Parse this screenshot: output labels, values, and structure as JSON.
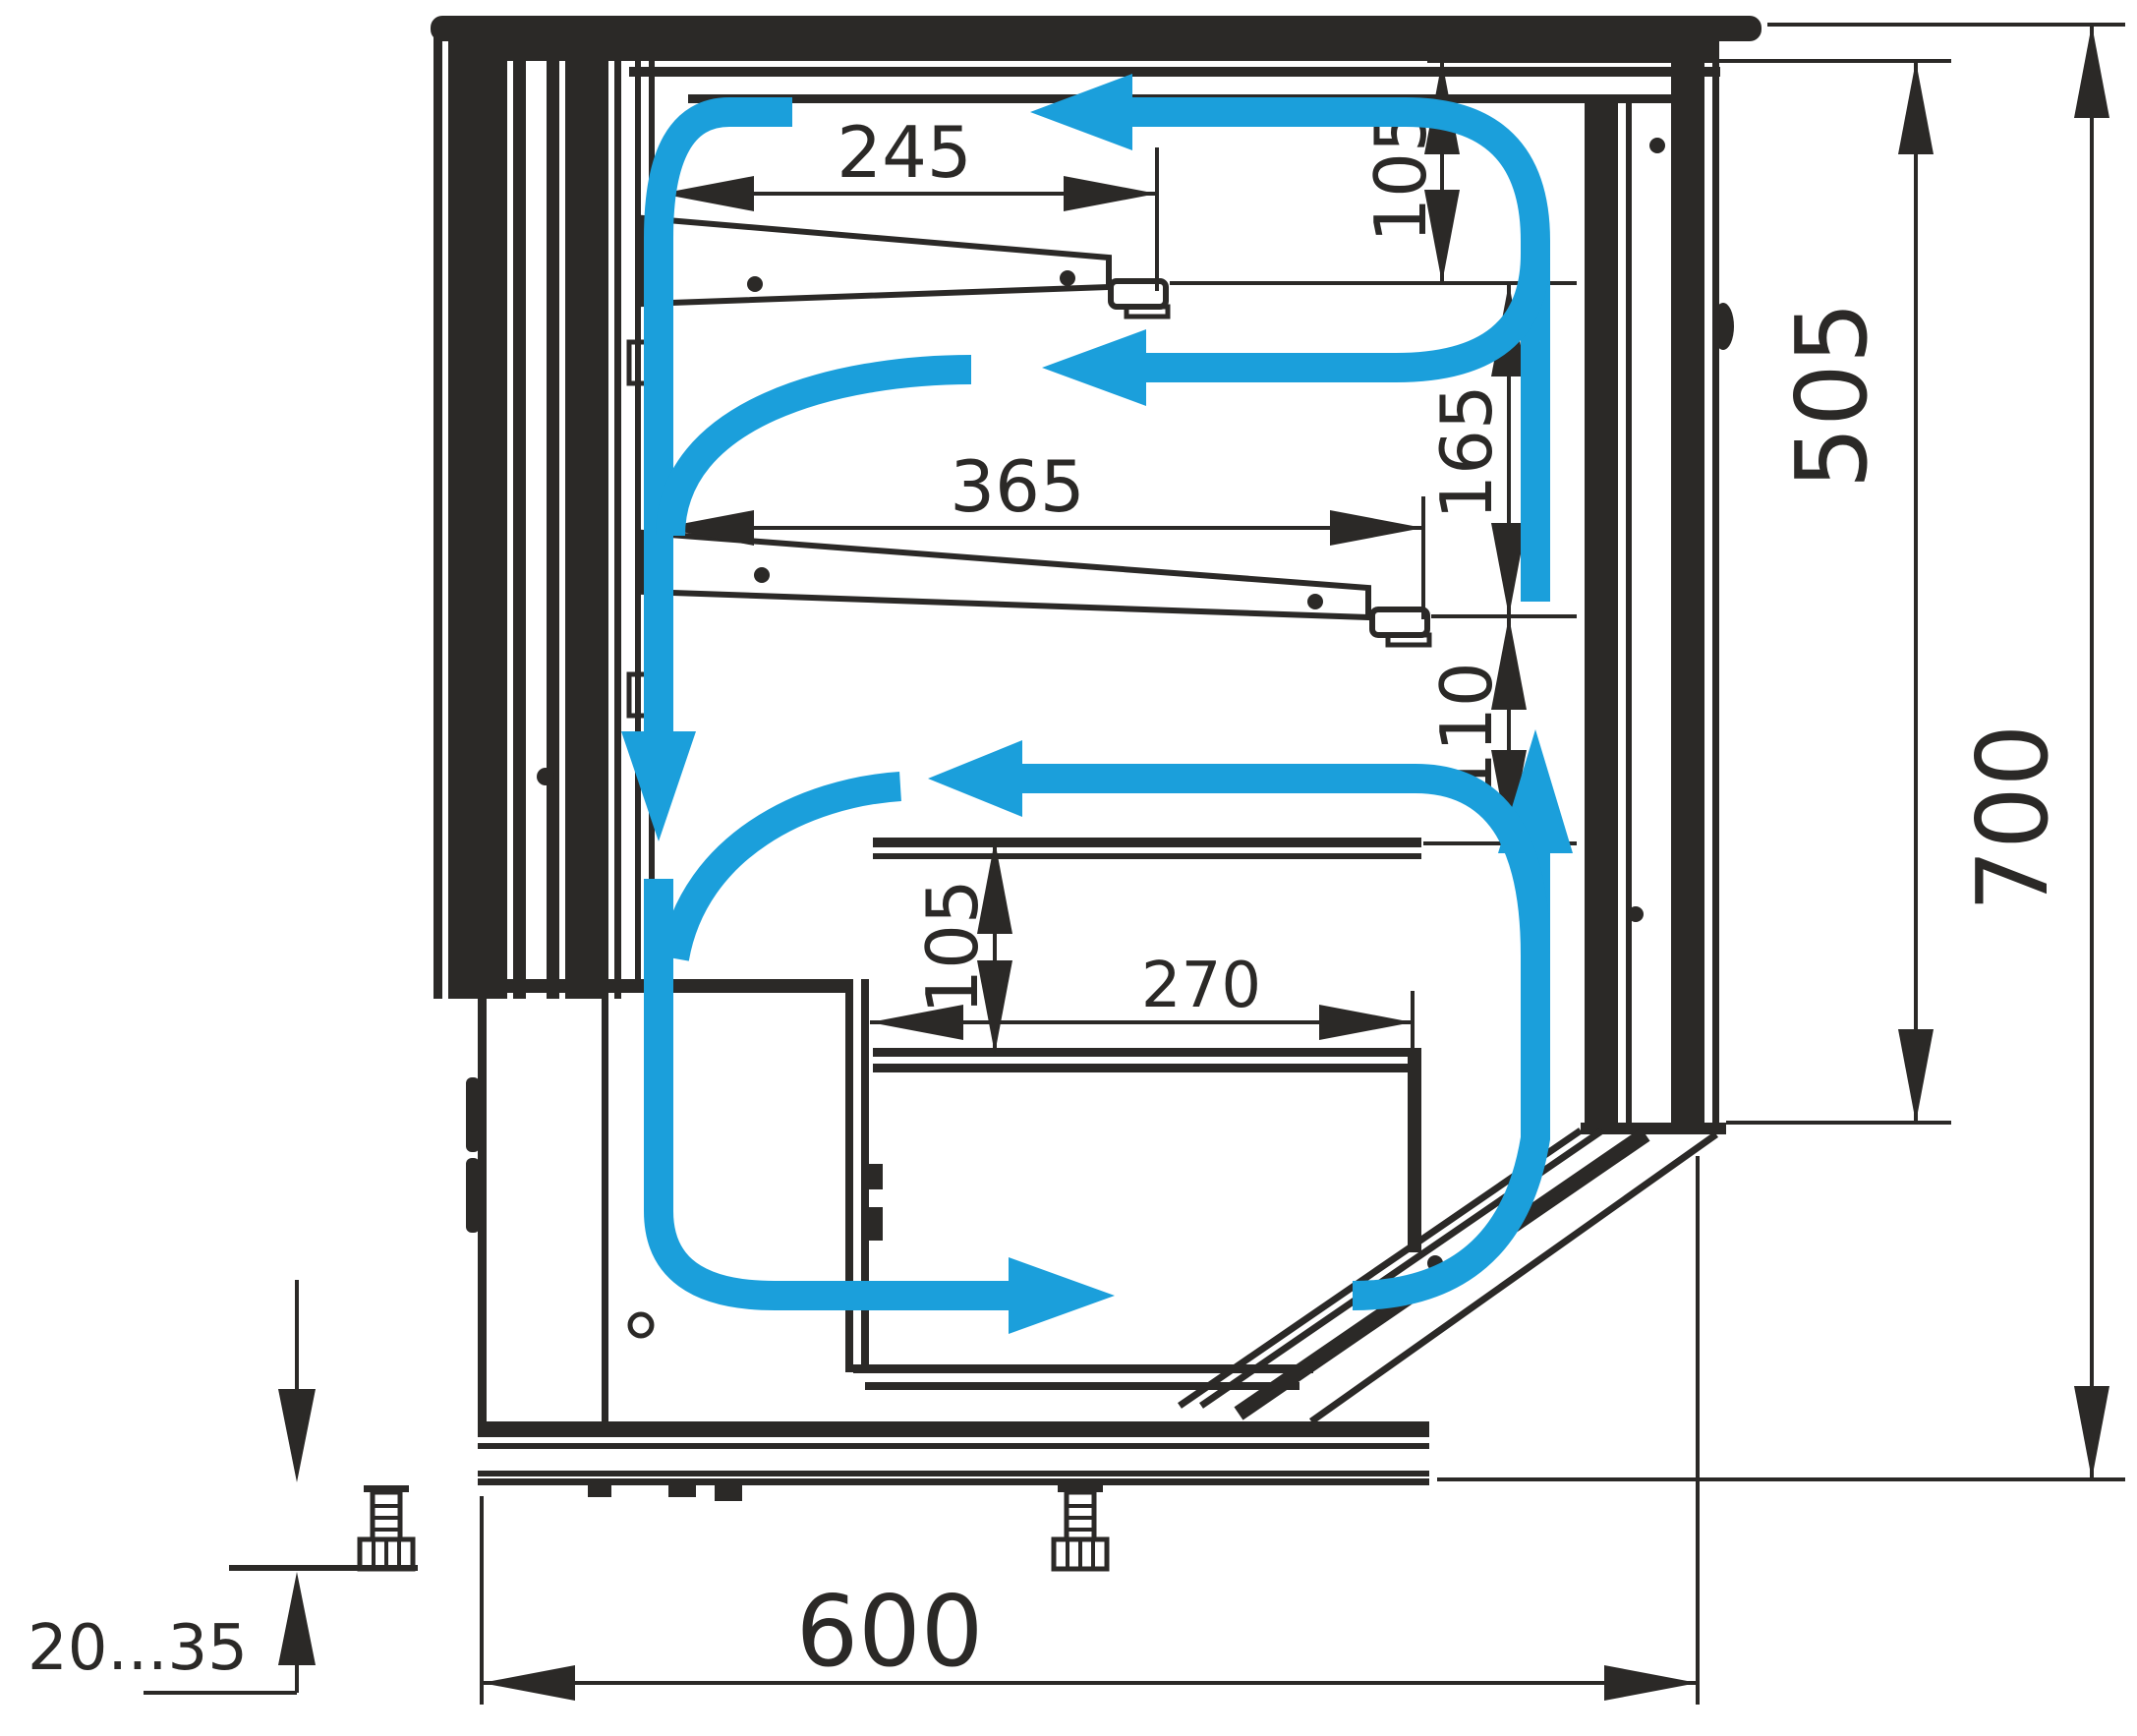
{
  "drawing": {
    "kind": "refrigerated-display-case-side-section-with-airflow",
    "dimensions": {
      "shelf_top_depth": {
        "label": "245"
      },
      "shelf_mid_depth": {
        "label": "365"
      },
      "gap_canopy_shelf": {
        "label": "105"
      },
      "gap_between_shelves": {
        "label": "165"
      },
      "gap_shelf_to_well": {
        "label": "110"
      },
      "well_depth": {
        "label": "105"
      },
      "well_length": {
        "label": "270"
      },
      "opening_height": {
        "label": "505"
      },
      "overall_height": {
        "label": "700"
      },
      "overall_depth": {
        "label": "600"
      },
      "foot_adjustment": {
        "label": "20...35"
      }
    },
    "colors": {
      "airflow_blue": "#1b9fdb",
      "line_ink": "#2b2927",
      "paper": "#ffffff"
    }
  }
}
